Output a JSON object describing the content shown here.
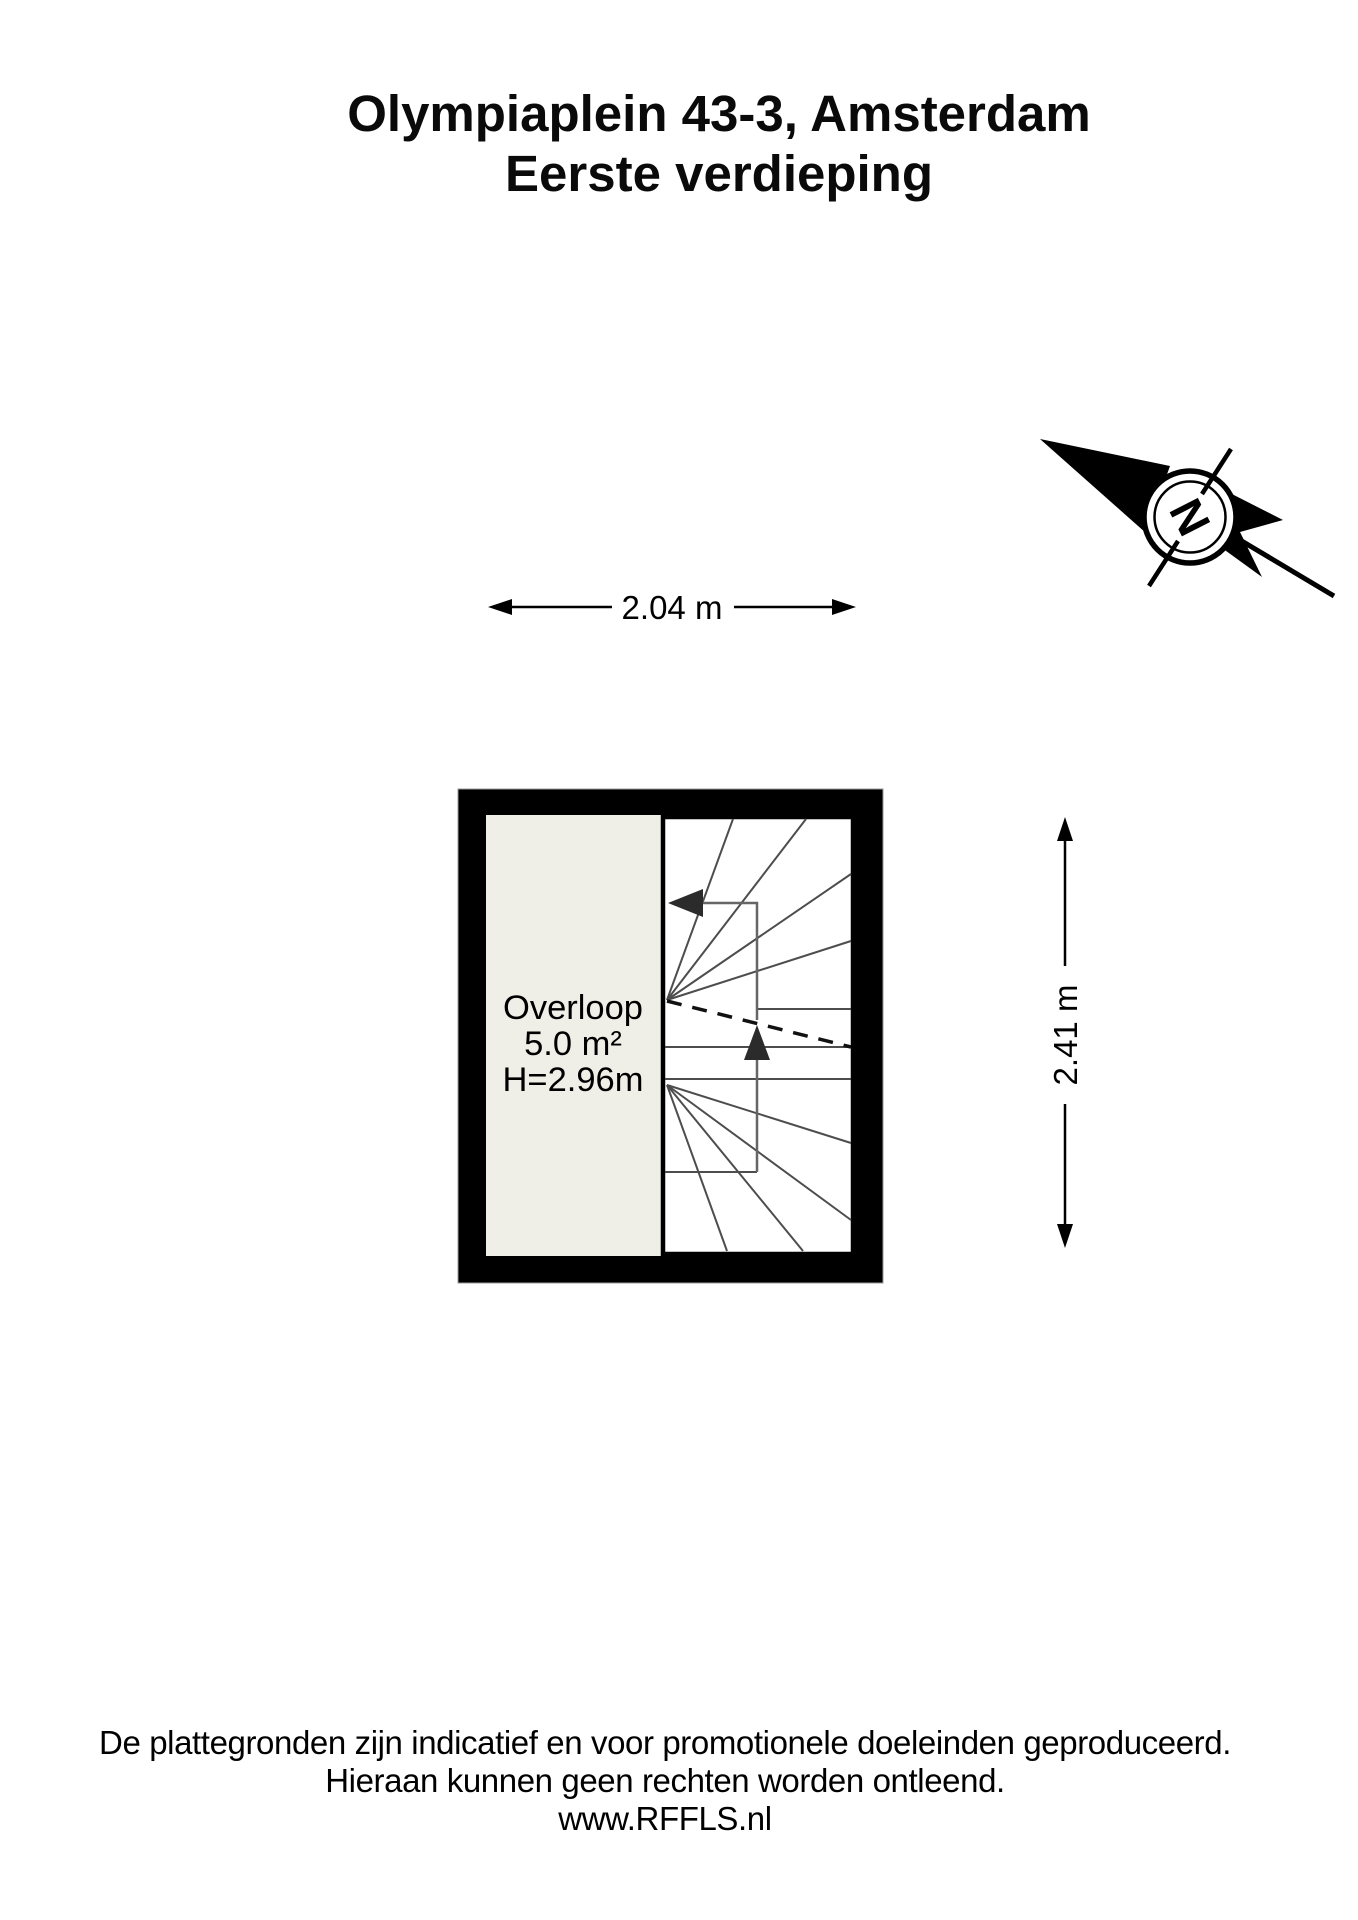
{
  "title": {
    "address": "Olympiaplein 43-3, Amsterdam",
    "floor": "Eerste verdieping"
  },
  "floorplan": {
    "room": {
      "name": "Overloop",
      "area": "5.0 m²",
      "ceiling_height": "H=2.96m"
    },
    "dimensions": {
      "width": "2.04 m",
      "height": "2.41 m"
    },
    "compass": {
      "north_label": "N"
    }
  },
  "footer": {
    "line1": "De plattegronden zijn indicatief en voor promotionele doeleinden geproduceerd.",
    "line2": "Hieraan kunnen geen rechten worden ontleend.",
    "line3": "www.RFFLS.nl"
  },
  "colors": {
    "wall": "#000000",
    "room_fill": "#efeee7",
    "stair_line": "#4d4d4d",
    "walk_line": "#666666",
    "background": "#ffffff"
  }
}
